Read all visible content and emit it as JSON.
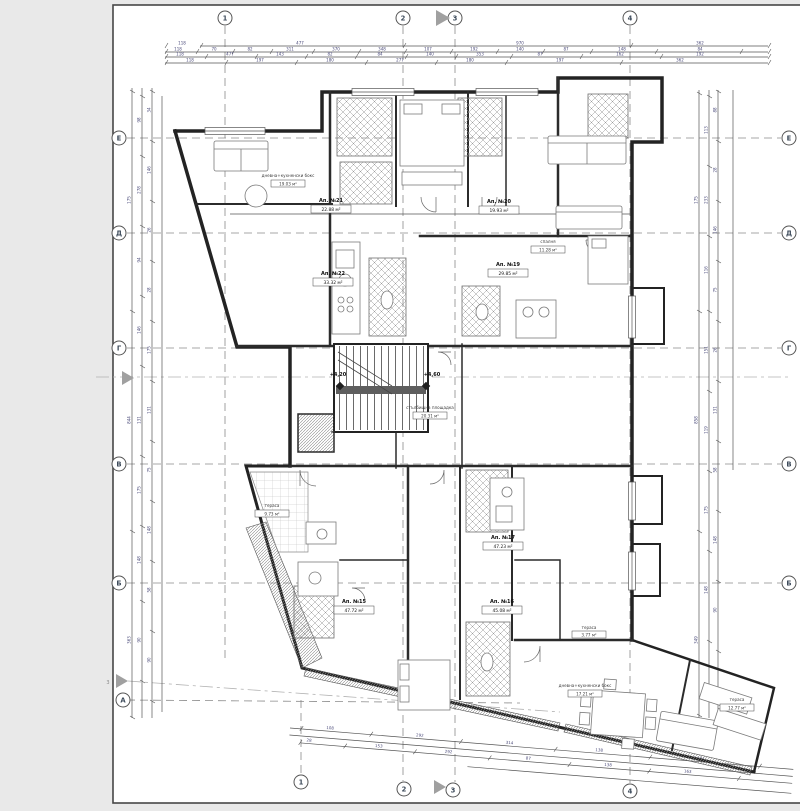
{
  "drawing": {
    "type": "architectural floor plan",
    "language": "Bulgarian",
    "paper_color": "#ffffff",
    "background_color": "#e9e9e9",
    "line_color": "#2a2a2a",
    "dim_color": "#4a4a7a"
  },
  "grid": {
    "cols_top": [
      "1",
      "2",
      "3",
      "4"
    ],
    "cols_bottom": [
      "1",
      "2",
      "3",
      "4"
    ],
    "rows_left": [
      "Е",
      "Д",
      "Г",
      "В",
      "Б",
      "А"
    ],
    "rows_right": [
      "Е",
      "Д",
      "Г",
      "В",
      "Б"
    ]
  },
  "markers": {
    "section_label": "3"
  },
  "levels": {
    "left": "+4,20",
    "right": "+4,60"
  },
  "apartments": {
    "a21": {
      "name": "Ап. №21",
      "area": "22.88 м²"
    },
    "a22": {
      "name": "Ап. №22",
      "area": "33.32 м²"
    },
    "a20": {
      "name": "Ап. №20",
      "area": "19.93 м²"
    },
    "a19": {
      "name": "Ап. №19",
      "area": "29.85 м²"
    },
    "a17": {
      "name": "Ап. №17",
      "area": "47.23 м²"
    },
    "a16": {
      "name": "Ап. №16",
      "area": "45.08 м²"
    },
    "a15": {
      "name": "Ап. №15",
      "area": "47.72 м²"
    }
  },
  "rooms": {
    "living_tl": {
      "name": "дневна+кухненски бокс",
      "area": "19.03 м²"
    },
    "bedroom_tr": {
      "name": "спалня",
      "area": "11.28 м²"
    },
    "stair": {
      "name": "стълбищна площадка",
      "area": "20.31 м²"
    },
    "living_br": {
      "name": "дневна+кухненски бокс",
      "area": "17.21 м²"
    },
    "terrace_l": {
      "name": "тераса",
      "area": "9.73 м²"
    },
    "terrace_m": {
      "name": "тераса",
      "area": "3.77 м²"
    },
    "terrace_br": {
      "name": "тераса",
      "area": "12.77 м²"
    }
  },
  "dims": {
    "t1": [
      "118",
      "477",
      "970",
      "362"
    ],
    "t2": [
      "118",
      "70",
      "82",
      "311",
      "370",
      "348",
      "107",
      "192",
      "140",
      "87",
      "148",
      "84"
    ],
    "t3": [
      "118",
      "477",
      "143",
      "82",
      "84",
      "140",
      "353",
      "87",
      "162",
      "192"
    ],
    "t4": [
      "118",
      "197",
      "180",
      "277",
      "180",
      "197",
      "362"
    ],
    "l1": [
      "175",
      "844",
      "363"
    ],
    "l2": [
      "98",
      "278",
      "94",
      "146",
      "131",
      "175",
      "148",
      "90"
    ],
    "l3": [
      "34",
      "146",
      "26",
      "28",
      "175",
      "131",
      "75",
      "148",
      "58",
      "90"
    ],
    "r1": [
      "175",
      "858",
      "349"
    ],
    "r2": [
      "113",
      "233",
      "116",
      "151",
      "119",
      "175",
      "148"
    ],
    "r3": [
      "88",
      "28",
      "146",
      "75",
      "26",
      "131",
      "58",
      "148",
      "90"
    ],
    "b1": [
      "108",
      "292",
      "314",
      "138",
      "1.934"
    ],
    "b2": [
      "28",
      "153",
      "292",
      "87",
      "138",
      "163"
    ]
  }
}
